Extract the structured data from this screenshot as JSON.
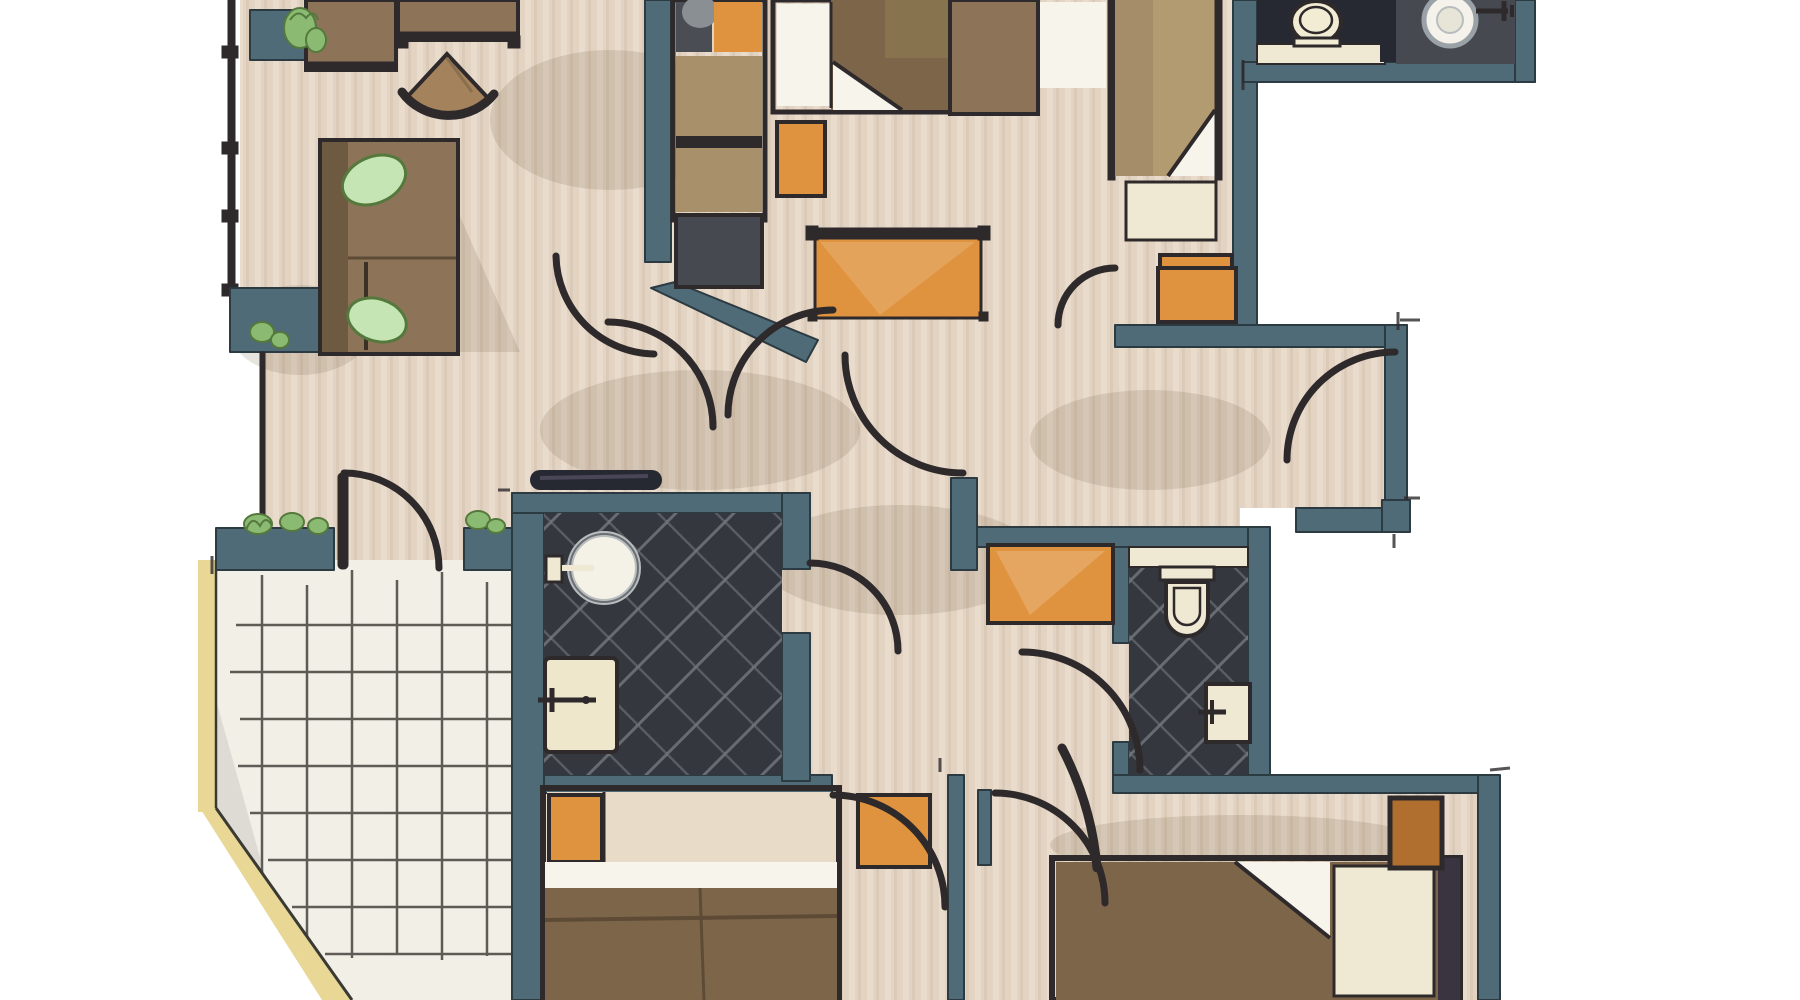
{
  "document": {
    "type": "floor-plan-illustration",
    "style": "hand-drawn watercolor architectural plan, top-down view, no text labels visible"
  },
  "colors": {
    "wall": "#4e6b77",
    "wall_edge": "#2c3a42",
    "line": "#2e2a2b",
    "floor": "#e2d3c2",
    "floor_light": "#ecdfd0",
    "streak": "#cdb9a5",
    "bath": "#34373d",
    "tile_line": "#9aa2a8",
    "orange": "#e0933f",
    "orange_deep": "#c97f2e",
    "brown": "#8d7458",
    "brown_dark": "#6e5a41",
    "blanket": "#7d6549",
    "bed_tan": "#b29a71",
    "cream": "#efe8d2",
    "white_soft": "#f7f4ec",
    "green": "#8bbb72",
    "green_dark": "#55793d",
    "green_light": "#c6e5b4",
    "terrace": "#f2efe7",
    "terrace_line": "#45423a",
    "yellow": "#e8d795",
    "gray_shower": "#464a50",
    "navy": "#262932",
    "shadow": "rgba(120,98,76,0.18)"
  },
  "rooms": [
    {
      "id": "living-room",
      "furniture": [
        "sideboard",
        "console-table",
        "fan-chair",
        "sofa-with-leaf-cushions",
        "balcony-planters",
        "railing"
      ]
    },
    {
      "id": "bedroom-top-middle",
      "furniture": [
        "wardrobe",
        "double-bed-with-fold",
        "nightstand",
        "orange-desk"
      ]
    },
    {
      "id": "bedroom-top-right",
      "furniture": [
        "single-bed-with-fold",
        "side-table",
        "cream-nightstand",
        "orange-rug"
      ]
    },
    {
      "id": "ensuite-top-right",
      "furniture": [
        "toilet",
        "counter",
        "round-shower-drain",
        "mixer-handle"
      ]
    },
    {
      "id": "shower-room",
      "furniture": [
        "round-washbasin",
        "bathtub-vanity",
        "wall-console"
      ]
    },
    {
      "id": "wc-bathroom",
      "furniture": [
        "toilet",
        "counter",
        "washbasin",
        "orange-sideboard"
      ]
    },
    {
      "id": "middle-right-room",
      "furniture": [
        "orange-mat"
      ]
    },
    {
      "id": "terrace",
      "furniture": [
        "tile-grid",
        "planters"
      ]
    },
    {
      "id": "bedroom-bottom-middle",
      "furniture": [
        "double-bed-orange-pillow",
        "orange-rug"
      ]
    },
    {
      "id": "bedroom-bottom-right",
      "furniture": [
        "double-bed-with-fold",
        "orange-nightstand"
      ]
    },
    {
      "id": "hallway",
      "furniture": [
        "door-arcs"
      ]
    }
  ]
}
